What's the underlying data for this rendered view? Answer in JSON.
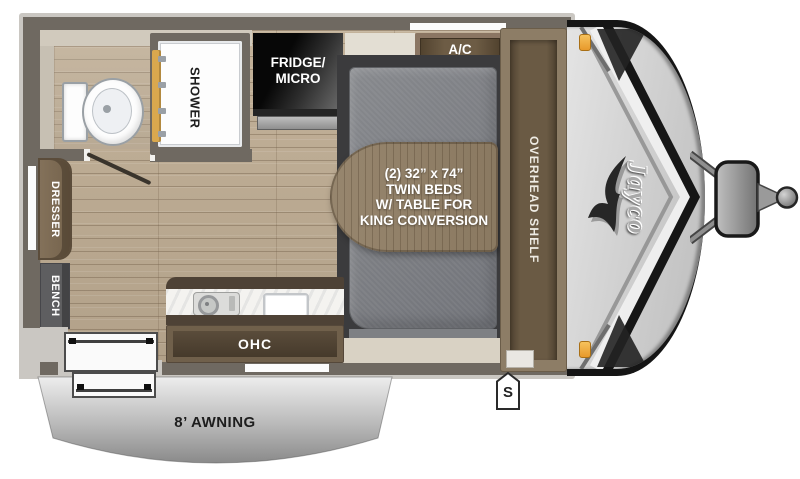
{
  "floorplan": {
    "bathroom": {
      "shower_label": "SHOWER"
    },
    "kitchen": {
      "fridge_label": "FRIDGE/\nMICRO",
      "ohc_label": "OHC"
    },
    "bedroom": {
      "ac_label": "A/C",
      "bed_table_label": "(2) 32” x 74”\nTWIN BEDS\nW/ TABLE FOR\nKING CONVERSION",
      "overhead_shelf_label": "OVERHEAD SHELF"
    },
    "living": {
      "dresser_label": "DRESSER",
      "bench_label": "BENCH"
    },
    "exterior": {
      "awning_label": "8’ AWNING",
      "s_marker": "S",
      "brand_logo": "Jayco"
    }
  },
  "colors": {
    "wall": "#6f6961",
    "wall_edge": "#cac7c2",
    "floor_wood": "#bcab93",
    "cabinet_brown": "#70604b",
    "cabinet_brown_dark": "#4e4236",
    "table_wood": "#93826a",
    "mattress_gray": "#7c7e82",
    "shower_door_gold": "#d9a84e",
    "marker_light_orange": "#f2a93b",
    "cap_gray": "#cecece",
    "graphic_black": "#151515"
  }
}
